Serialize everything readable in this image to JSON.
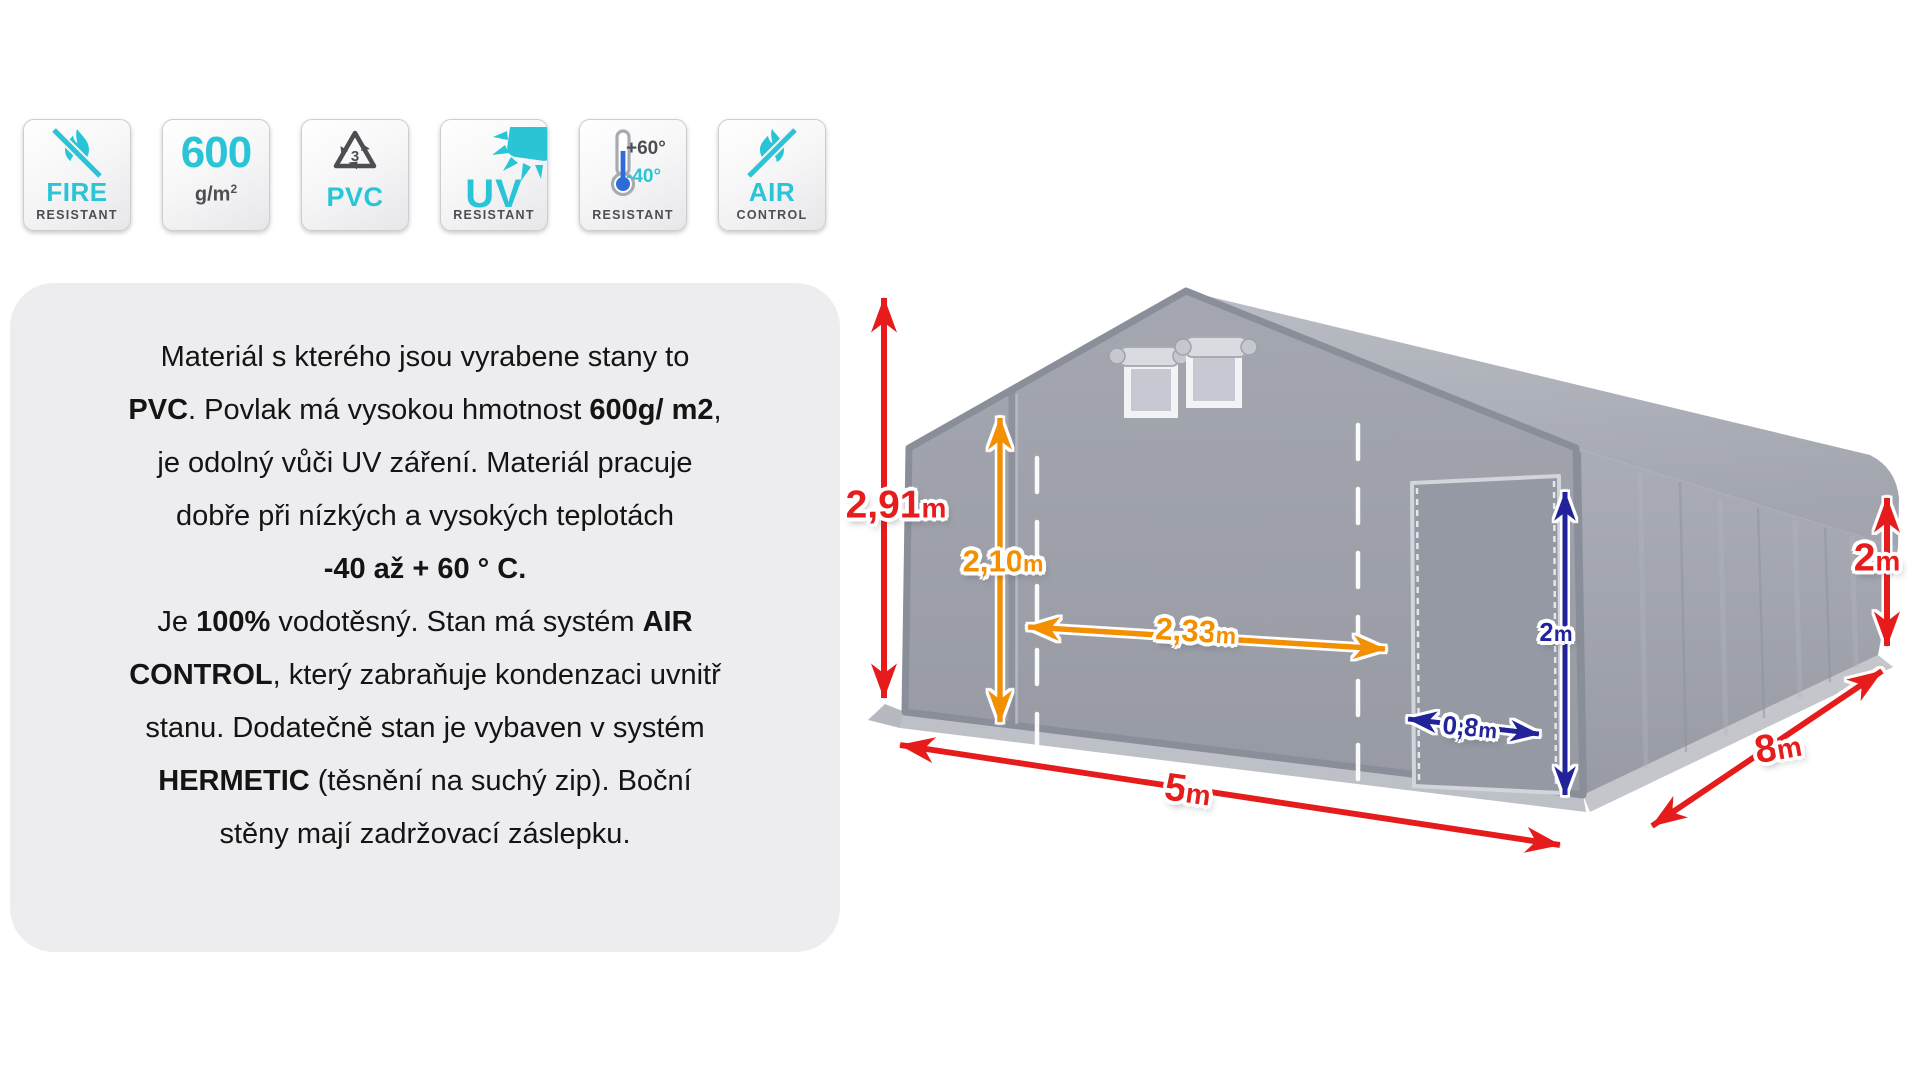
{
  "colors": {
    "teal": "#29c5d6",
    "icon_gray": "#4b4e53",
    "red": "#e61d1d",
    "orange": "#f29000",
    "navy": "#22249a",
    "therm_blue": "#2e6bd8",
    "card_bg": "#ededf0"
  },
  "badges": [
    {
      "id": "fire-resistant",
      "title": "FIRE",
      "subtitle": "RESISTANT",
      "icon": "flame-slash-icon"
    },
    {
      "id": "weight",
      "value": "600",
      "unit": "g/m",
      "sup": "2"
    },
    {
      "id": "pvc-material",
      "number": "3",
      "title": "PVC",
      "icon": "recycling-icon"
    },
    {
      "id": "uv-resistant",
      "title": "UV",
      "subtitle": "RESISTANT",
      "icon": "sun-icon"
    },
    {
      "id": "temperature-resistant",
      "high": "+60°",
      "low": "-40°",
      "subtitle": "RESISTANT",
      "icon": "thermometer-icon"
    },
    {
      "id": "air-control",
      "title": "AIR",
      "subtitle": "CONTROL",
      "icon": "flame-slash-icon"
    }
  ],
  "description": {
    "lines": [
      [
        {
          "t": "Materiál s kterého jsou vyrabene stany to"
        }
      ],
      [
        {
          "t": "PVC",
          "b": true
        },
        {
          "t": ". Povlak má vysokou hmotnost "
        },
        {
          "t": "600g/ m2",
          "b": true
        },
        {
          "t": ","
        }
      ],
      [
        {
          "t": "je odolný vůči UV záření. Materiál pracuje"
        }
      ],
      [
        {
          "t": "dobře při nízkých a vysokých teplotách"
        }
      ],
      [
        {
          "t": "-40 až + 60 ° C.",
          "b": true
        }
      ],
      [
        {
          "t": "Je "
        },
        {
          "t": "100%",
          "b": true
        },
        {
          "t": " vodotěsný. Stan má systém "
        },
        {
          "t": "AIR",
          "b": true
        }
      ],
      [
        {
          "t": "CONTROL",
          "b": true
        },
        {
          "t": ", který zabraňuje kondenzaci uvnitř"
        }
      ],
      [
        {
          "t": "stanu. Dodatečně stan je vybaven v systém"
        }
      ],
      [
        {
          "t": "HERMETIC",
          "b": true
        },
        {
          "t": " (těsnění na suchý zip). Boční"
        }
      ],
      [
        {
          "t": "stěny mají zadržovací záslepku."
        }
      ]
    ]
  },
  "diagram": {
    "dimensions": {
      "total_height": {
        "value": "2,91",
        "unit": "m"
      },
      "front_wall_height": {
        "value": "2,10",
        "unit": "m"
      },
      "entrance_width": {
        "value": "2,33",
        "unit": "m"
      },
      "door_height": {
        "value": "2",
        "unit": "m"
      },
      "door_width": {
        "value": "0,8",
        "unit": "m"
      },
      "side_wall_height": {
        "value": "2",
        "unit": "m"
      },
      "front_width": {
        "value": "5",
        "unit": "m"
      },
      "length": {
        "value": "8",
        "unit": "m"
      }
    }
  }
}
